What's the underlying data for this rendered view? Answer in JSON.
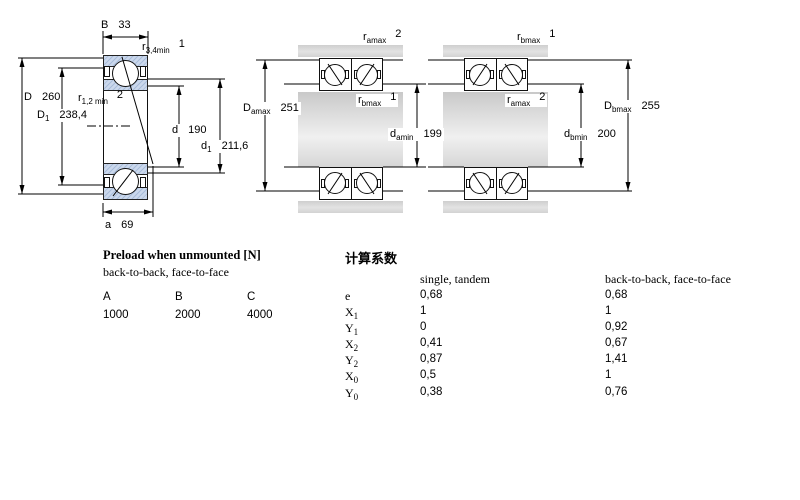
{
  "left_diagram": {
    "B": {
      "sym": "B",
      "val": "33"
    },
    "r34": {
      "sym": "r",
      "sub": "3,4min",
      "note": "1"
    },
    "r12": {
      "sym": "r",
      "sub": "1,2 min",
      "note": "2"
    },
    "D": {
      "sym": "D",
      "val": "260"
    },
    "D1": {
      "sym": "D",
      "sub": "1",
      "val": "238,4"
    },
    "d": {
      "sym": "d",
      "val": "190"
    },
    "d1": {
      "sym": "d",
      "sub": "1",
      "val": "211,6"
    },
    "a": {
      "sym": "a",
      "val": "69"
    }
  },
  "middle_diagram": {
    "r_housing": {
      "sym": "r",
      "sub": "amax",
      "note": "2"
    },
    "r_shaft": {
      "sym": "r",
      "sub": "bmax",
      "note": "1"
    },
    "Da": {
      "sym": "D",
      "sub": "amax",
      "val": "251"
    },
    "da": {
      "sym": "d",
      "sub": "amin",
      "val": "199"
    }
  },
  "right_diagram": {
    "r_housing": {
      "sym": "r",
      "sub": "bmax",
      "note": "1"
    },
    "r_shaft": {
      "sym": "r",
      "sub": "amax",
      "note": "2"
    },
    "Db": {
      "sym": "D",
      "sub": "bmax",
      "val": "255"
    },
    "db": {
      "sym": "d",
      "sub": "bmin",
      "val": "200"
    }
  },
  "preload": {
    "title": "Preload when unmounted [N]",
    "subtitle": "back-to-back, face-to-face",
    "columns": [
      "A",
      "B",
      "C"
    ],
    "values": [
      "1000",
      "2000",
      "4000"
    ]
  },
  "factors": {
    "title": "计算系数",
    "col1_header": "single, tandem",
    "col2_header": "back-to-back, face-to-face",
    "rows": [
      {
        "sym": "e",
        "sub": "",
        "single": "0,68",
        "paired": "0,68"
      },
      {
        "sym": "X",
        "sub": "1",
        "single": "1",
        "paired": "1"
      },
      {
        "sym": "Y",
        "sub": "1",
        "single": "0",
        "paired": "0,92"
      },
      {
        "sym": "X",
        "sub": "2",
        "single": "0,41",
        "paired": "0,67"
      },
      {
        "sym": "Y",
        "sub": "2",
        "single": "0,87",
        "paired": "1,41"
      },
      {
        "sym": "X",
        "sub": "0",
        "single": "0,5",
        "paired": "1"
      },
      {
        "sym": "Y",
        "sub": "0",
        "single": "0,38",
        "paired": "0,76"
      }
    ]
  },
  "colors": {
    "ring_fill": "#cbd8ec",
    "ring_hatch": "#a9bdda",
    "steel_gray": "#d6d6d6",
    "line": "#000000"
  }
}
